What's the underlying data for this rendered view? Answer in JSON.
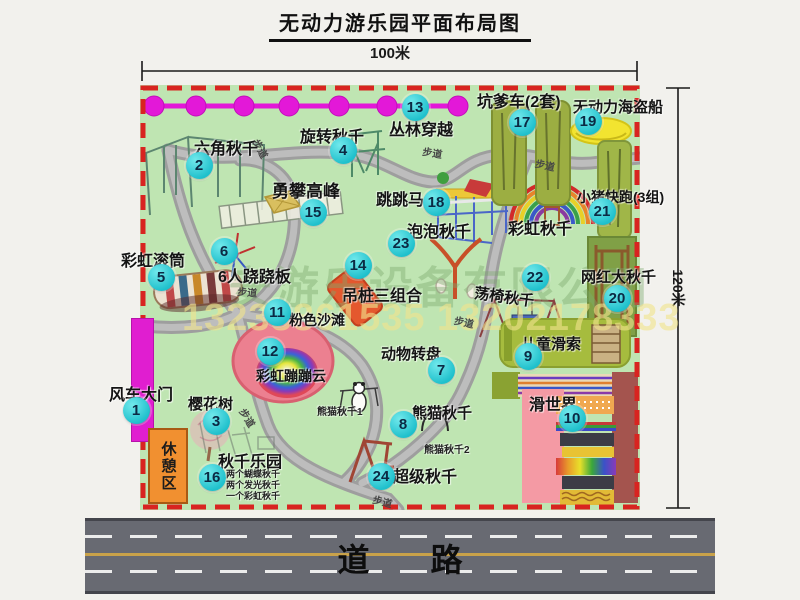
{
  "title": "无动力游乐园平面布局图",
  "dimensions": {
    "width": "100米",
    "height": "120米"
  },
  "watermark": {
    "company": "安游乐设备有限公司",
    "phone": "13233861535 13202178333"
  },
  "road": {
    "label": "道 路"
  },
  "rest_area": {
    "label": "休憩区"
  },
  "colors": {
    "map_green": "#bfe5b2",
    "border_red": "#d82420",
    "badge_cyan": "#2cc8d2",
    "gate_magenta": "#e01ed0",
    "jungle_line_magenta": "#e318d8",
    "road_gray": "#686a72",
    "rest_area_orange": "#f19030"
  },
  "attractions": [
    {
      "num": "1",
      "name": "风车大门",
      "label": [
        109,
        381,
        16
      ],
      "badge": [
        136,
        410
      ]
    },
    {
      "num": "2",
      "name": "六角秋千",
      "label": [
        194,
        135,
        16
      ],
      "badge": [
        199,
        165
      ]
    },
    {
      "num": "3",
      "name": "樱花树",
      "label": [
        188,
        393,
        15
      ],
      "badge": [
        216,
        421
      ]
    },
    {
      "num": "4",
      "name": "旋转秋千",
      "label": [
        300,
        123,
        16
      ],
      "badge": [
        343,
        150
      ]
    },
    {
      "num": "5",
      "name": "彩虹滚筒",
      "label": [
        121,
        247,
        16
      ],
      "badge": [
        161,
        277
      ]
    },
    {
      "num": "6",
      "name": "6人跷跷板",
      "label": [
        218,
        263,
        16
      ],
      "badge": [
        224,
        251
      ]
    },
    {
      "num": "7",
      "name": "动物转盘",
      "label": [
        381,
        343,
        15
      ],
      "badge": [
        441,
        370
      ]
    },
    {
      "num": "8",
      "name": "熊猫秋千",
      "label": [
        412,
        402,
        15
      ],
      "badge": [
        403,
        424
      ]
    },
    {
      "num": "9",
      "name": "儿童滑索",
      "label": [
        521,
        333,
        15
      ],
      "badge": [
        528,
        356
      ]
    },
    {
      "num": "10",
      "name": "滑世界",
      "label": [
        529,
        391,
        16
      ],
      "badge": [
        572,
        418
      ]
    },
    {
      "num": "11",
      "name": "粉色沙滩",
      "label": [
        289,
        310,
        14
      ],
      "badge": [
        277,
        312
      ]
    },
    {
      "num": "12",
      "name": "彩虹蹦蹦云",
      "label": [
        256,
        366,
        14
      ],
      "badge": [
        270,
        351
      ]
    },
    {
      "num": "13",
      "name": "丛林穿越",
      "label": [
        389,
        116,
        16
      ],
      "badge": [
        415,
        107
      ]
    },
    {
      "num": "14",
      "name": "吊桩三组合",
      "label": [
        342,
        282,
        16
      ],
      "badge": [
        358,
        265
      ]
    },
    {
      "num": "15",
      "name": "勇攀高峰",
      "label": [
        272,
        177,
        17
      ],
      "badge": [
        313,
        212
      ]
    },
    {
      "num": "16",
      "name": "秋千乐园",
      "label": [
        218,
        448,
        16
      ],
      "badge": [
        212,
        477
      ]
    },
    {
      "num": "17",
      "name": "坑爹车(2套)",
      "label": [
        477,
        88,
        16
      ],
      "badge": [
        522,
        122
      ]
    },
    {
      "num": "18",
      "name": "跳跳马",
      "label": [
        376,
        186,
        16
      ],
      "badge": [
        436,
        202
      ]
    },
    {
      "num": "19",
      "name": "无动力海盗船",
      "label": [
        573,
        96,
        15
      ],
      "badge": [
        588,
        121
      ]
    },
    {
      "num": "20",
      "name": "网红大秋千",
      "label": [
        581,
        266,
        15
      ],
      "badge": [
        617,
        298
      ]
    },
    {
      "num": "21",
      "name": "小猪快跑(3组)",
      "label": [
        577,
        187,
        14
      ],
      "badge": [
        602,
        211
      ]
    },
    {
      "num": "22",
      "name": "荡椅秋千",
      "label": [
        476,
        282,
        15,
        8
      ],
      "badge": [
        535,
        277
      ]
    },
    {
      "num": "23",
      "name": "泡泡秋千",
      "label": [
        407,
        218,
        16
      ],
      "badge": [
        401,
        243
      ]
    },
    {
      "num": "24",
      "name": "超级秋千",
      "label": [
        393,
        463,
        16
      ],
      "badge": [
        381,
        476
      ]
    }
  ],
  "extra_labels": [
    {
      "text": "彩虹秋千",
      "pos": [
        508,
        215,
        16
      ]
    },
    {
      "text": "熊猫秋千1",
      "pos": [
        317,
        403,
        10
      ],
      "small": true
    },
    {
      "text": "熊猫秋千2",
      "pos": [
        424,
        441,
        10
      ],
      "small": true
    },
    {
      "text": "两个蝴蝶秋千",
      "pos": [
        226,
        467,
        9
      ],
      "small": true
    },
    {
      "text": "两个发光秋千",
      "pos": [
        226,
        478,
        9
      ],
      "small": true
    },
    {
      "text": "一个彩虹秋千",
      "pos": [
        226,
        489,
        9
      ],
      "small": true
    }
  ],
  "walkway_labels": [
    {
      "text": "步道",
      "pos": [
        263,
        136,
        10,
        62
      ]
    },
    {
      "text": "步道",
      "pos": [
        424,
        143,
        10,
        10
      ]
    },
    {
      "text": "步道",
      "pos": [
        537,
        155,
        10,
        12
      ]
    },
    {
      "text": "步道",
      "pos": [
        238,
        283,
        10,
        5
      ]
    },
    {
      "text": "步道",
      "pos": [
        456,
        312,
        10,
        12
      ]
    },
    {
      "text": "步道",
      "pos": [
        249,
        405,
        10,
        58
      ]
    },
    {
      "text": "步道",
      "pos": [
        375,
        491,
        10,
        15
      ]
    }
  ]
}
